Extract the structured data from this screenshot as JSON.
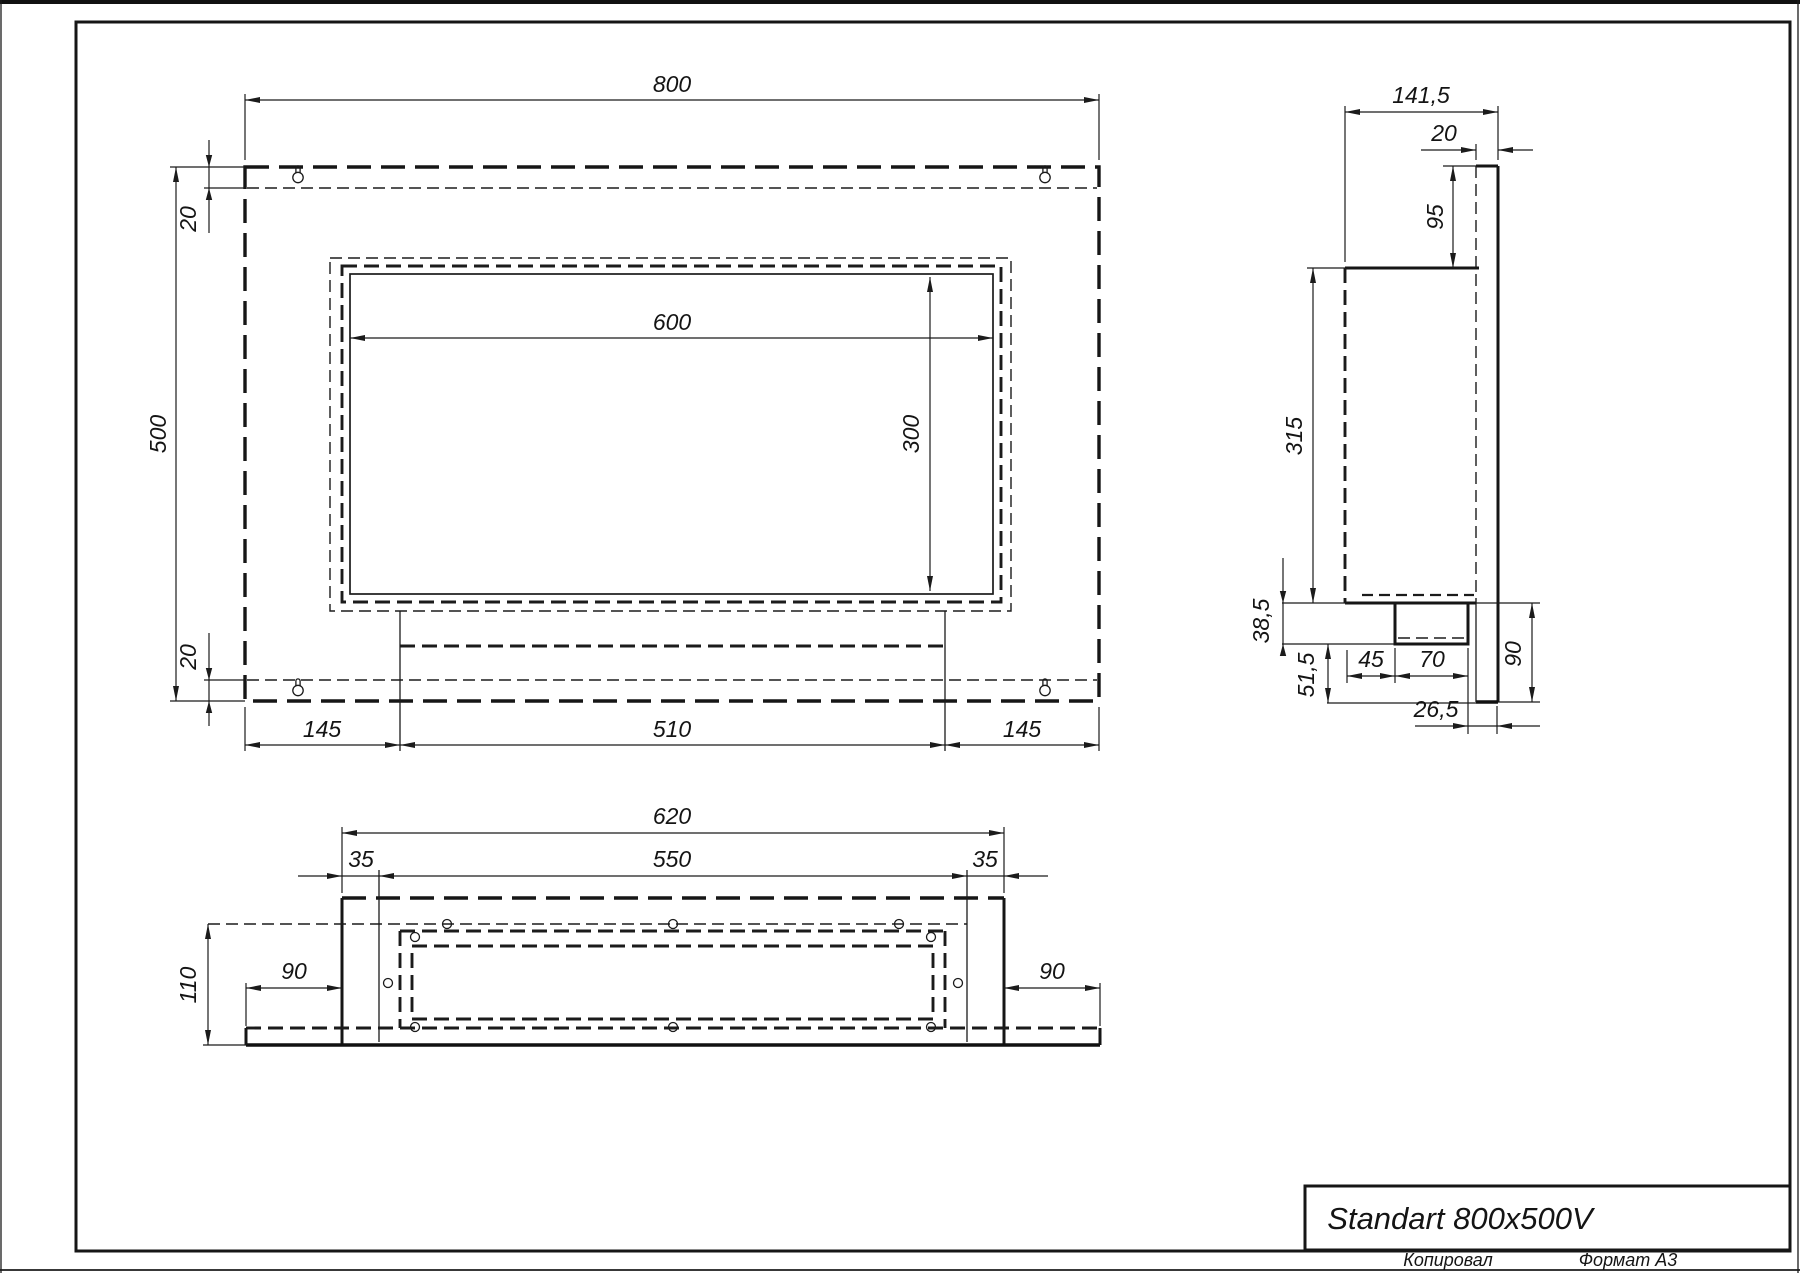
{
  "title_block": {
    "name": "Standart 800x500V"
  },
  "footer": {
    "copied": "Копировал",
    "format": "Формат А3"
  },
  "front_view": {
    "dims": {
      "width": "800",
      "height": "500",
      "top_flange": "20",
      "bottom_flange": "20",
      "opening_width": "600",
      "opening_height": "300",
      "left_margin": "145",
      "tray_width": "510",
      "right_margin": "145"
    }
  },
  "side_view": {
    "dims": {
      "depth": "141,5",
      "plate_thickness": "20",
      "top_offset": "95",
      "box_height": "315",
      "tray_drop": "38,5",
      "bottom_offset": "51,5",
      "burner_front_offset": "45",
      "burner_depth": "70",
      "lower_height": "90",
      "burner_back_gap": "26,5"
    }
  },
  "bottom_view": {
    "dims": {
      "body_width": "620",
      "tank_width": "550",
      "left_inset": "35",
      "right_inset": "35",
      "depth": "110",
      "left_margin": "90",
      "right_margin": "90"
    }
  }
}
